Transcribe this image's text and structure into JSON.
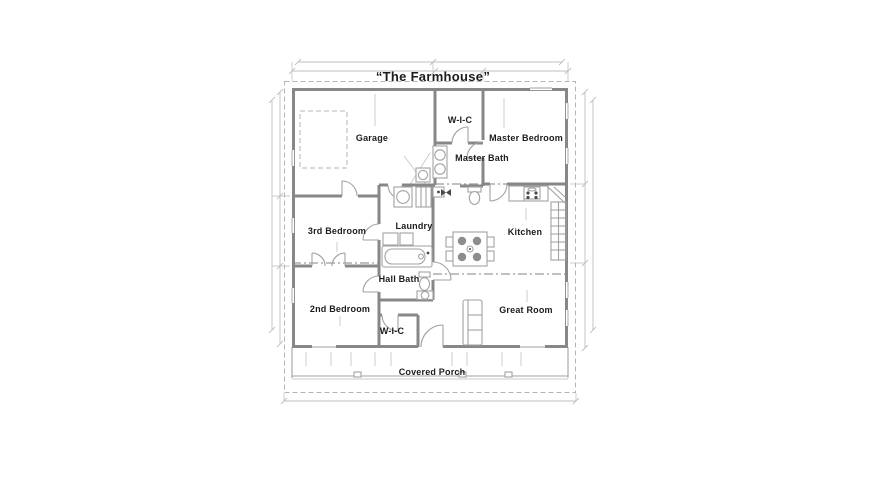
{
  "title": "“The Farmhouse”",
  "rooms": [
    {
      "name": "garage",
      "label": "Garage"
    },
    {
      "name": "master-closet",
      "label": "W-I-C"
    },
    {
      "name": "master-bedroom",
      "label": "Master Bedroom"
    },
    {
      "name": "master-bath",
      "label": "Master Bath"
    },
    {
      "name": "third-bedroom",
      "label": "3rd Bedroom"
    },
    {
      "name": "laundry",
      "label": "Laundry"
    },
    {
      "name": "kitchen",
      "label": "Kitchen"
    },
    {
      "name": "hall-bath",
      "label": "Hall Bath"
    },
    {
      "name": "second-bedroom",
      "label": "2nd Bedroom"
    },
    {
      "name": "second-closet",
      "label": "W-I-C"
    },
    {
      "name": "great-room",
      "label": "Great Room"
    },
    {
      "name": "covered-porch",
      "label": "Covered Porch"
    }
  ],
  "colors": {
    "background": "#ffffff",
    "wall": "#878787",
    "thin": "#a2a2a2",
    "faint": "#c8c8c8",
    "dashline": "#b5b5b5",
    "dim": "#bfbfbf",
    "text": "#1c1c1c",
    "chair": "#8d8d8d"
  }
}
